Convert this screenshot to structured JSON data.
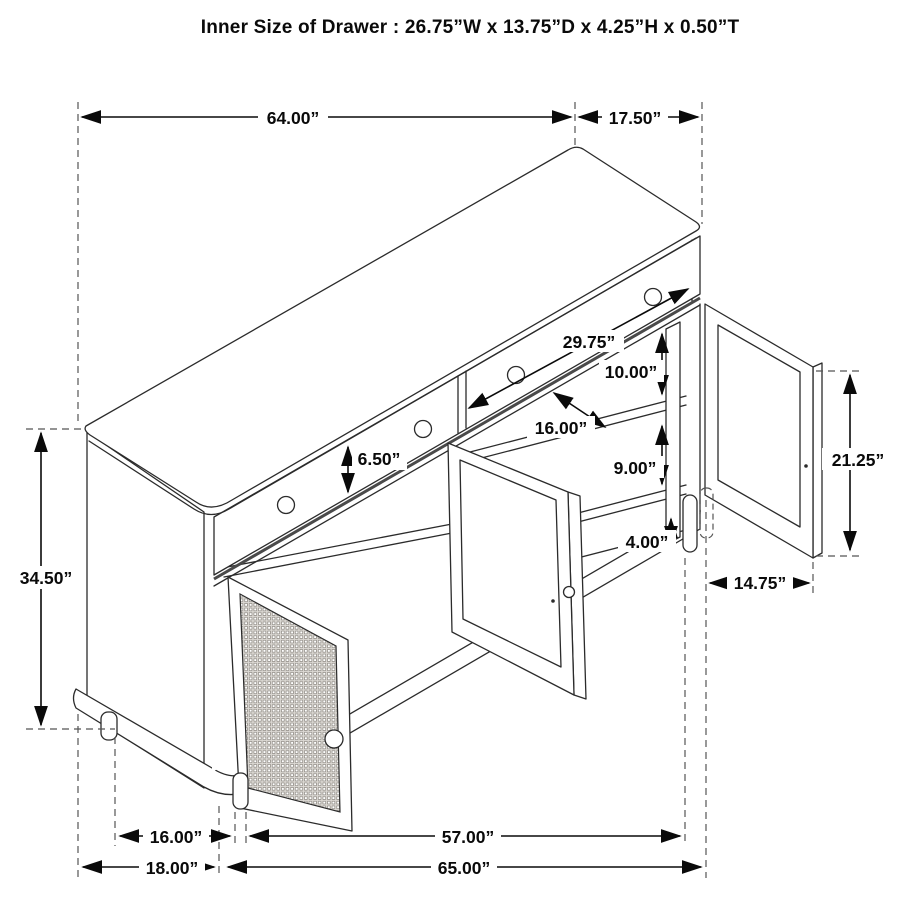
{
  "title": "Inner Size of Drawer : 26.75”W x 13.75”D x 4.25”H x 0.50”T",
  "dims": {
    "top_width": "64.00”",
    "top_depth": "17.50”",
    "overall_height": "34.50”",
    "drawer_front_height": "6.50”",
    "inner_width": "29.75”",
    "upper_shelf_gap": "10.00”",
    "shelf_depth": "16.00”",
    "lower_shelf_gap": "9.00”",
    "base_height": "4.00”",
    "door_height": "21.25”",
    "door_width": "14.75”",
    "leg_span_side": "16.00”",
    "leg_span_front": "57.00”",
    "floor_depth": "18.00”",
    "floor_width": "65.00”"
  }
}
